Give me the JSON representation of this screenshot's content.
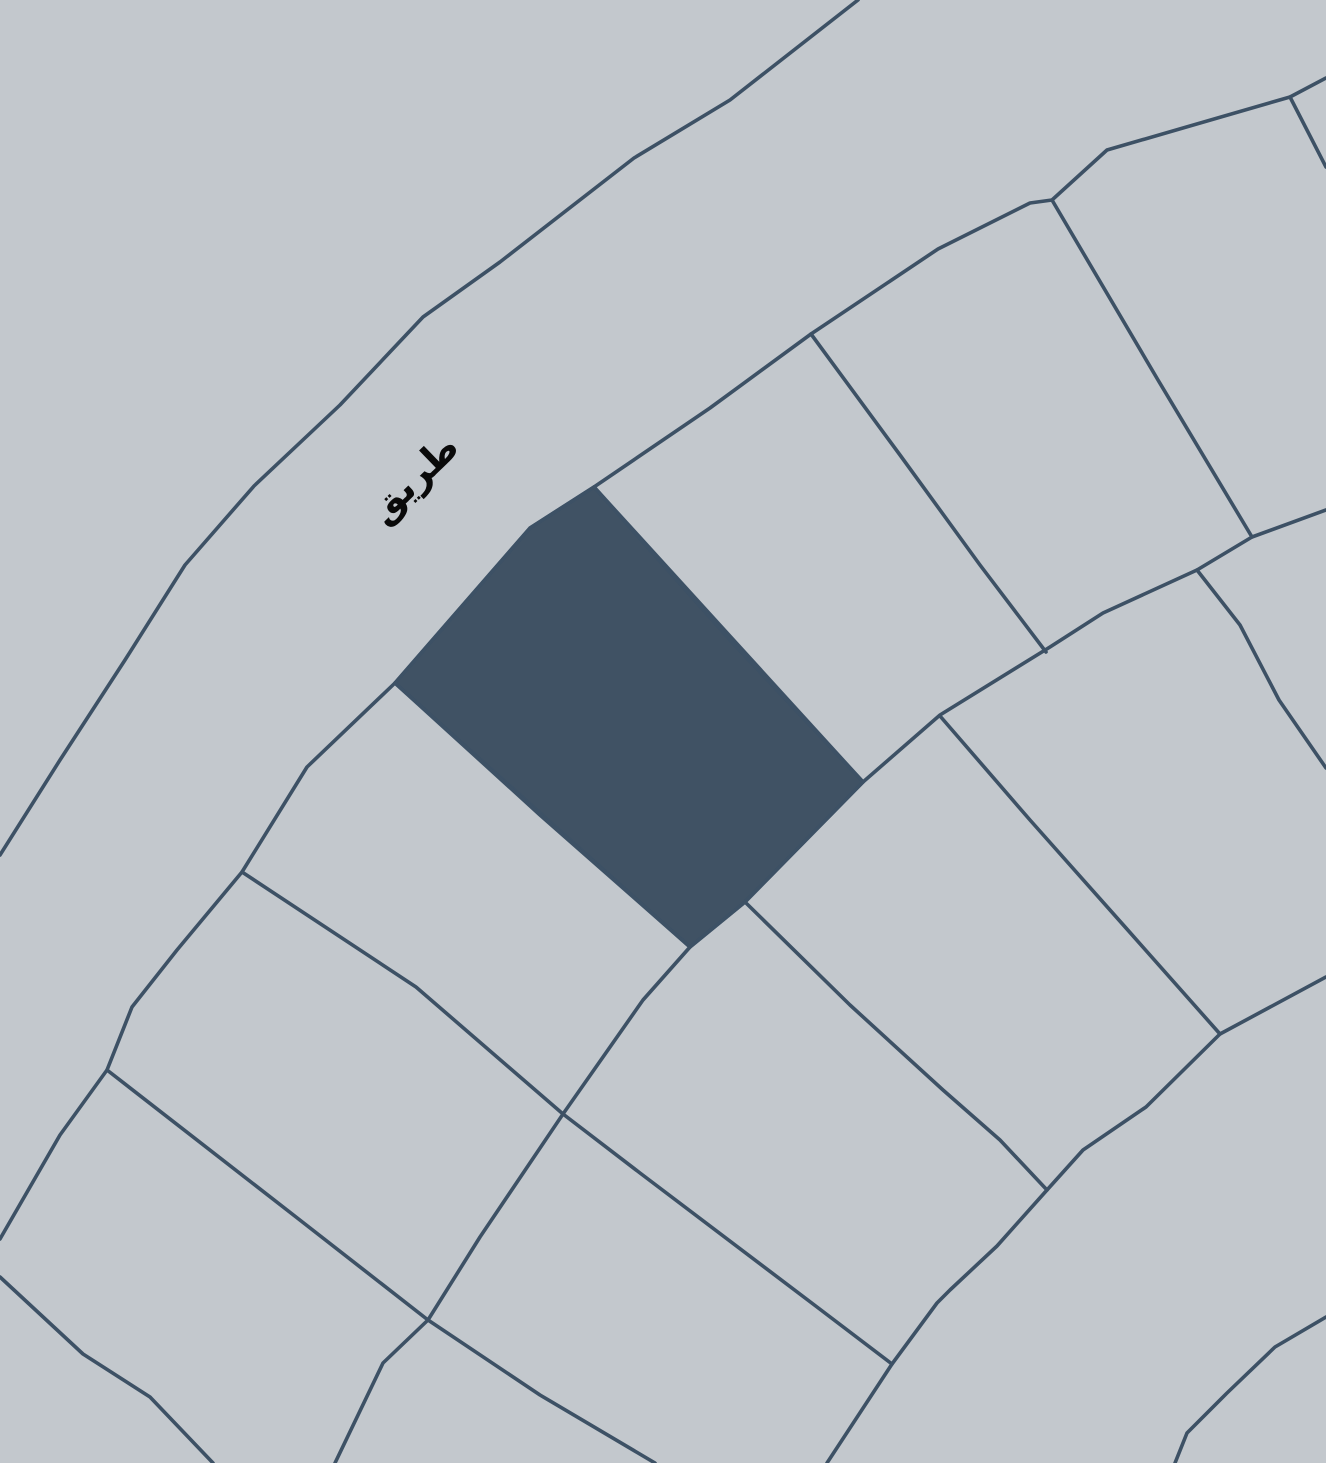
{
  "map": {
    "road_label": "طريق",
    "colors": {
      "background": "#c3c8cd",
      "line": "#3d5165",
      "highlight_fill": "#405264",
      "label_text": "#0a0a0a"
    },
    "label": {
      "x": 415,
      "y": 480,
      "rotation": -44
    },
    "highlighted_parcel": {
      "name": "highlighted-parcel",
      "points": [
        [
          594,
          487
        ],
        [
          863,
          782
        ],
        [
          745,
          902
        ],
        [
          690,
          947
        ],
        [
          395,
          683
        ],
        [
          530,
          528
        ]
      ]
    },
    "lines": [
      {
        "name": "road-outer-edge",
        "points": [
          [
            858,
            0
          ],
          [
            730,
            100
          ],
          [
            634,
            158
          ],
          [
            500,
            262
          ],
          [
            423,
            317
          ],
          [
            340,
            405
          ],
          [
            254,
            486
          ],
          [
            185,
            565
          ],
          [
            125,
            660
          ],
          [
            60,
            760
          ],
          [
            0,
            855
          ]
        ]
      },
      {
        "name": "road-inner-edge",
        "points": [
          [
            1326,
            78
          ],
          [
            1290,
            97
          ],
          [
            1107,
            150
          ],
          [
            1052,
            200
          ],
          [
            1030,
            203
          ],
          [
            938,
            249
          ],
          [
            811,
            334
          ],
          [
            710,
            408
          ],
          [
            594,
            487
          ],
          [
            530,
            528
          ],
          [
            395,
            683
          ],
          [
            307,
            767
          ],
          [
            242,
            872
          ],
          [
            177,
            950
          ],
          [
            132,
            1007
          ],
          [
            107,
            1070
          ],
          [
            60,
            1135
          ],
          [
            0,
            1239
          ]
        ]
      },
      {
        "name": "divider-top-right-corner",
        "points": [
          [
            1290,
            97
          ],
          [
            1326,
            167
          ]
        ]
      },
      {
        "name": "divider-row1-a",
        "points": [
          [
            1052,
            200
          ],
          [
            1158,
            380
          ],
          [
            1252,
            537
          ]
        ]
      },
      {
        "name": "divider-row1-b",
        "points": [
          [
            811,
            334
          ],
          [
            900,
            455
          ],
          [
            980,
            565
          ],
          [
            1046,
            652
          ]
        ]
      },
      {
        "name": "highlighted-parcel-right-edge",
        "points": [
          [
            594,
            487
          ],
          [
            730,
            640
          ],
          [
            863,
            782
          ]
        ]
      },
      {
        "name": "highlighted-parcel-left-edge",
        "points": [
          [
            395,
            683
          ],
          [
            540,
            815
          ],
          [
            690,
            947
          ]
        ]
      },
      {
        "name": "inner-arc-boundary",
        "points": [
          [
            1326,
            510
          ],
          [
            1252,
            537
          ],
          [
            1197,
            570
          ],
          [
            1103,
            613
          ],
          [
            1050,
            647
          ],
          [
            940,
            715
          ],
          [
            863,
            782
          ],
          [
            745,
            902
          ],
          [
            690,
            947
          ],
          [
            643,
            1000
          ],
          [
            563,
            1114
          ],
          [
            480,
            1237
          ],
          [
            428,
            1320
          ],
          [
            383,
            1363
          ],
          [
            335,
            1463
          ]
        ]
      },
      {
        "name": "divider-row2-a",
        "points": [
          [
            1197,
            570
          ],
          [
            1240,
            625
          ],
          [
            1279,
            700
          ],
          [
            1326,
            768
          ]
        ]
      },
      {
        "name": "divider-row2-b",
        "points": [
          [
            940,
            716
          ],
          [
            1030,
            820
          ],
          [
            1126,
            928
          ],
          [
            1220,
            1034
          ]
        ]
      },
      {
        "name": "divider-row2-c",
        "points": [
          [
            745,
            902
          ],
          [
            850,
            1005
          ],
          [
            943,
            1090
          ],
          [
            1000,
            1140
          ],
          [
            1047,
            1190
          ]
        ]
      },
      {
        "name": "long-radial-divider",
        "points": [
          [
            242,
            872
          ],
          [
            416,
            987
          ],
          [
            563,
            1114
          ],
          [
            640,
            1173
          ],
          [
            817,
            1307
          ],
          [
            892,
            1364
          ]
        ]
      },
      {
        "name": "divider-bottom-left-a",
        "points": [
          [
            107,
            1070
          ],
          [
            296,
            1217
          ],
          [
            428,
            1320
          ],
          [
            540,
            1395
          ],
          [
            655,
            1463
          ]
        ]
      },
      {
        "name": "divider-bottom-left-b",
        "points": [
          [
            0,
            1277
          ],
          [
            83,
            1354
          ],
          [
            150,
            1397
          ],
          [
            213,
            1463
          ]
        ]
      },
      {
        "name": "second-road-inner-edge",
        "points": [
          [
            1326,
            977
          ],
          [
            1220,
            1034
          ],
          [
            1146,
            1107
          ],
          [
            1083,
            1150
          ],
          [
            1047,
            1190
          ],
          [
            997,
            1246
          ],
          [
            950,
            1290
          ],
          [
            937,
            1303
          ],
          [
            892,
            1364
          ],
          [
            827,
            1463
          ]
        ]
      },
      {
        "name": "second-road-outer-edge",
        "points": [
          [
            1326,
            1317
          ],
          [
            1275,
            1347
          ],
          [
            1227,
            1393
          ],
          [
            1187,
            1433
          ],
          [
            1175,
            1463
          ]
        ]
      }
    ]
  }
}
